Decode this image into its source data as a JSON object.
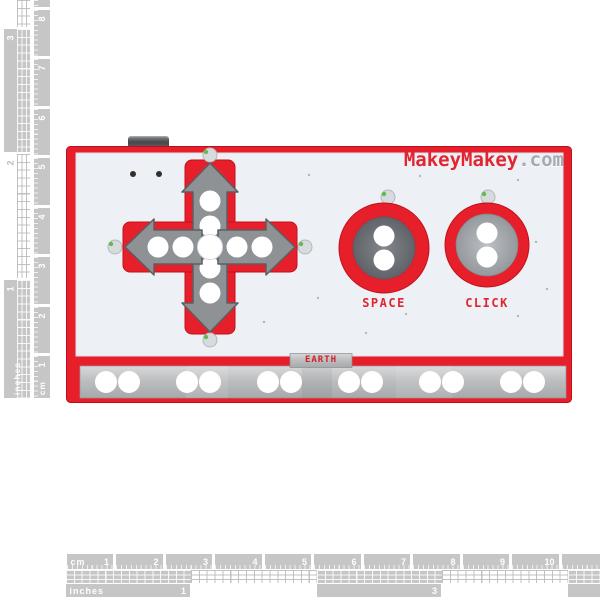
{
  "colors": {
    "ruler_gray": "#c6c6c6",
    "board_red": "#e71f2b",
    "board_face": "#edf0f5",
    "metal": "#bcbec0",
    "arrow_gray": "#8f9295",
    "brand_red": "#e22530",
    "brand_com_gray": "#a7abb1",
    "led_green": "#66b94e"
  },
  "rulers": {
    "left": {
      "inches_unit": "inches",
      "inches_labels": [
        "1",
        "2",
        "3",
        ""
      ],
      "cm_unit": "cm",
      "cm_labels": [
        "1",
        "2",
        "3",
        "4",
        "5",
        "6",
        "7",
        "8"
      ]
    },
    "bottom": {
      "cm_unit": "cm",
      "cm_labels": [
        "1",
        "2",
        "3",
        "4",
        "5",
        "6",
        "7",
        "8",
        "9",
        "10"
      ],
      "inches_unit": "inches",
      "inches_labels": [
        "1",
        "",
        "3",
        ""
      ]
    }
  },
  "board": {
    "brand_name": "MakeyMakey",
    "brand_domain": ".com",
    "space_label": "SPACE",
    "click_label": "CLICK",
    "earth_label": "EARTH"
  }
}
